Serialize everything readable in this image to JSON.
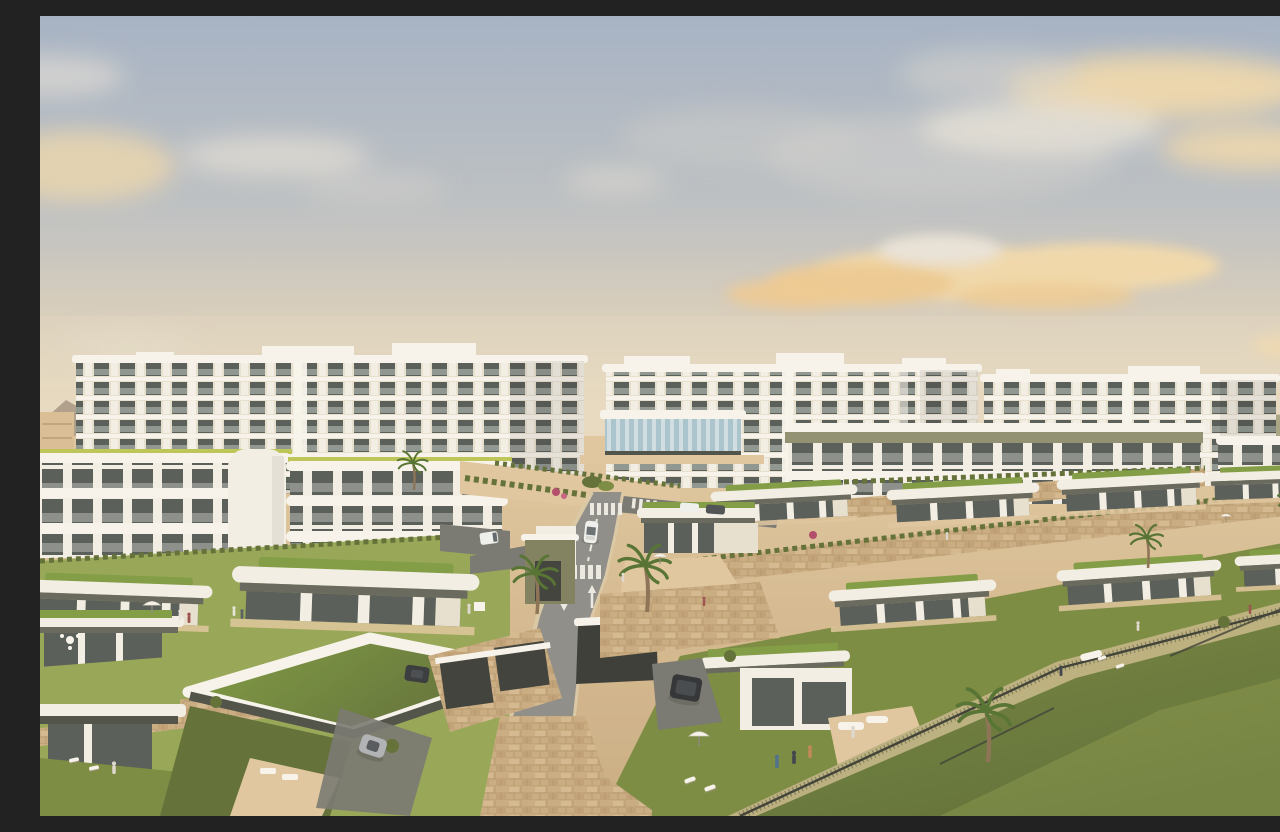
{
  "scene": {
    "type": "architectural-render",
    "description": "Aerial CGI render of a modern hillside residential resort at golden hour: three long white apartment blocks with stacked balconies in the background, curved white mid-rise buildings with lime and olive roof trim in the middle ground, terraced rows of single-storey villas with green planted roofs, beige stone retaining walls, gardens with tiny people, parasols and sun loungers, palm trees, a two-lane road with zebra crossings and painted lane arrows, several cars, and a large open lawn in the lower right under a pastel blue sky with cream sunset clouds."
  },
  "palette": {
    "sky_top": "#a4b2c6",
    "sky_mid": "#bcc0c4",
    "sky_low": "#d6cdbd",
    "horizon_glow": "#e9dcc2",
    "cloud_cream": "#f2d9ab",
    "cloud_deep": "#eeca92",
    "cloud_gray": "#d3d2cf",
    "cloud_pale": "#e9e3d8",
    "mountain": "#8f7c6c",
    "hill_green": "#7d7f5a",
    "tan_bldg": "#d9bd95",
    "bldg_white": "#f4f0e6",
    "bldg_cream": "#e8e1d1",
    "slab": "#f8f5ee",
    "bldg_shadow": "#cfc7b4",
    "win_dark": "#555a57",
    "win_mid": "#8b918d",
    "glass_rail": "#c6cdc9",
    "lime": "#bcc455",
    "olive_band": "#8f9070",
    "fascia_olive": "#64665a",
    "fascia_dark": "#4c4f45",
    "olive_wall": "#7e7f5e",
    "stone": "#c9ab81",
    "stone_dark": "#ad8c60",
    "stone_light": "#e0c79f",
    "grass_bright": "#94a654",
    "grass_mid": "#78893f",
    "grass_dark": "#5e6e35",
    "roof_grass": "#7e9b41",
    "dry_grass": "#c9b98b",
    "road": "#8d8c88",
    "road_dark": "#757570",
    "curb": "#dbc9a6",
    "marking": "#edebe3",
    "glass_pool": "#a9c3ce",
    "glass_pool2": "#cfdfe5",
    "palm_trunk": "#8b7054",
    "palm_leaf": "#52702f",
    "car_white": "#f0f1ef",
    "car_dark": "#2c2f32",
    "car_silver": "#aeb2b6",
    "fence": "#3a3d33"
  },
  "inventory": {
    "apartment_blocks": 3,
    "midrise_buildings": 4,
    "villas_visible": 14,
    "vehicles": [
      "white car on road",
      "white van on side drive",
      "dark SUV in driveway",
      "silver sports car",
      "dark sedan",
      "two parked cars"
    ],
    "road_markings": [
      "zebra crosswalk upper",
      "zebra crosswalk lower",
      "dashed center line",
      "up lane arrow",
      "down lane arrow"
    ],
    "vegetation": [
      "palm trees",
      "hedgerows",
      "bougainvillea",
      "green planted roofs",
      "large open lawn"
    ],
    "people_count_approx": 16,
    "furniture": [
      "white parasols",
      "sun loungers",
      "outdoor sofas",
      "garden dining set"
    ]
  }
}
